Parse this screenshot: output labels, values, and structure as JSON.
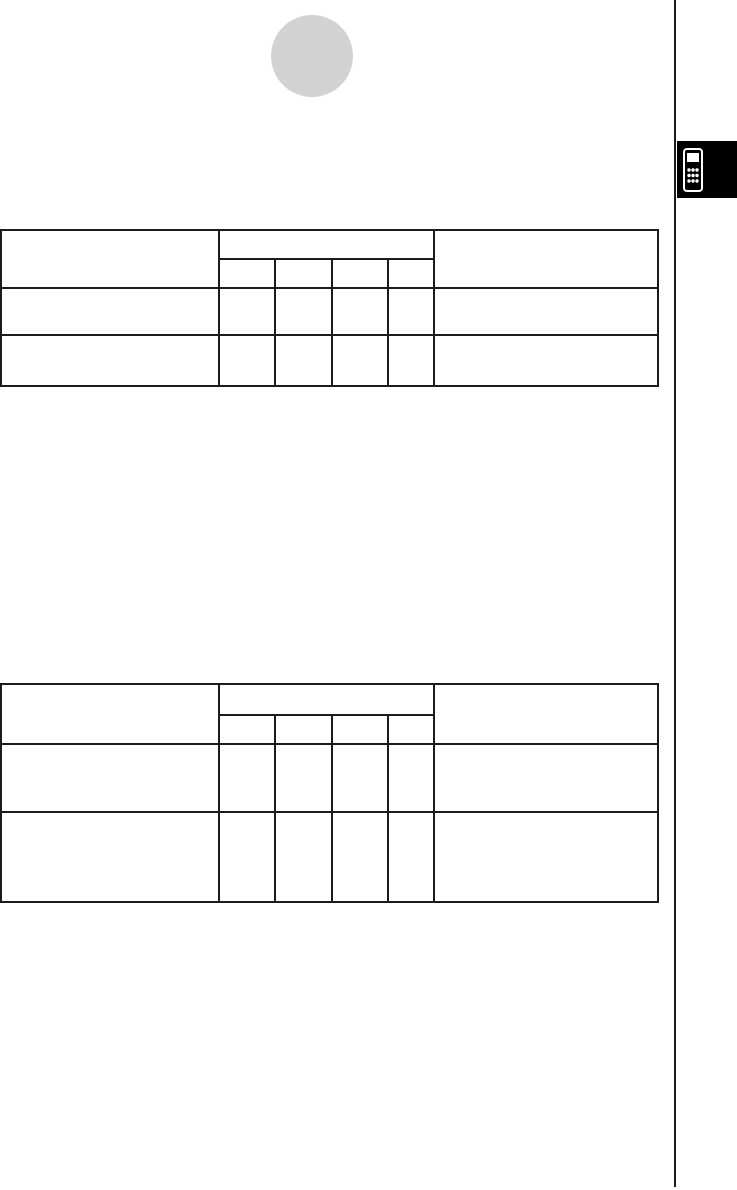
{
  "page": {
    "background": "#ffffff",
    "ink_color": "#1c1c1c"
  },
  "decorations": {
    "section_circle": {
      "color": "#d2d2d2"
    },
    "side_rule": {
      "color": "#1c1c1c"
    },
    "chapter_tab": {
      "background": "#000000",
      "icon": "calculator-icon",
      "icon_color": "#ffffff"
    }
  },
  "tables": [
    {
      "header": {
        "left": "",
        "group": "",
        "subcols": [
          "",
          "",
          "",
          ""
        ],
        "right": ""
      },
      "rows": [
        [
          "",
          "",
          "",
          "",
          "",
          ""
        ],
        [
          "",
          "",
          "",
          "",
          "",
          ""
        ]
      ]
    },
    {
      "header": {
        "left": "",
        "group": "",
        "subcols": [
          "",
          "",
          "",
          ""
        ],
        "right": ""
      },
      "rows": [
        [
          "",
          "",
          "",
          "",
          "",
          ""
        ],
        [
          "",
          "",
          "",
          "",
          "",
          ""
        ]
      ]
    }
  ]
}
